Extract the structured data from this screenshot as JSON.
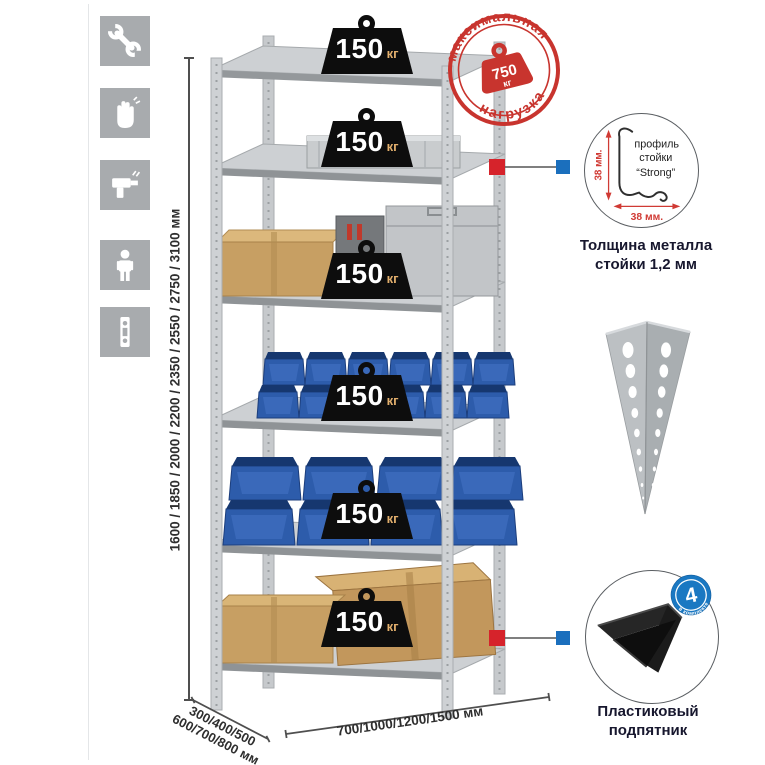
{
  "page": {
    "background": "#ffffff"
  },
  "left_toolbar": {
    "icons": [
      {
        "name": "wrench-icon"
      },
      {
        "name": "gloves-icon"
      },
      {
        "name": "drill-icon"
      },
      {
        "name": "person-icon"
      },
      {
        "name": "rack-profile-icon"
      }
    ]
  },
  "rack": {
    "shelf_count": 6,
    "shelf_loads": [
      {
        "value": "150",
        "unit": "кг"
      },
      {
        "value": "150",
        "unit": "кг"
      },
      {
        "value": "150",
        "unit": "кг"
      },
      {
        "value": "150",
        "unit": "кг"
      },
      {
        "value": "150",
        "unit": "кг"
      },
      {
        "value": "150",
        "unit": "кг"
      }
    ]
  },
  "max_load_stamp": {
    "arc_top": "максимальная",
    "arc_bottom": "нагрузка",
    "weight_value": "750",
    "weight_unit": "кг"
  },
  "callouts": {
    "profile": {
      "label_line1": "профиль",
      "label_line2": "стойки",
      "label_line3": "“Strong”",
      "dim_vertical": "38 мм.",
      "dim_horizontal": "38 мм.",
      "caption_line1": "Толщина металла",
      "caption_line2": "стойки 1,2 мм"
    },
    "foot": {
      "badge_value": "4",
      "badge_arc_text": "в комплекте",
      "caption_line1": "Пластиковый",
      "caption_line2": "подпятник"
    }
  },
  "dimensions": {
    "height_label": "1600 / 1850 / 2000 / 2200 / 2350 / 2550 / 2750 / 3100 мм",
    "depth_label_line1": "300/400/500",
    "depth_label_line2": "600/700/800 мм",
    "width_label": "700/1000/1200/1500 мм"
  },
  "colors": {
    "stamp_red": "#c8342e",
    "marker_red": "#d6232b",
    "marker_blue": "#1b6fbd",
    "bin_blue": "#2d5cab",
    "metal_gray": "#c6c9cc",
    "icon_tile_gray": "#a8abae",
    "kit_badge_blue": "#1a78c2"
  }
}
